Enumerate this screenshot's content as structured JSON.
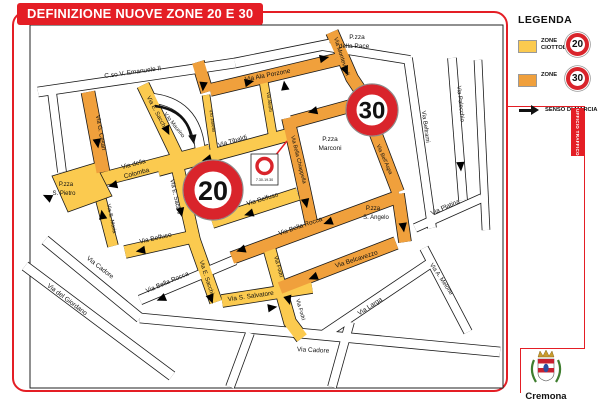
{
  "title": "DEFINIZIONE NUOVE ZONE 20 E 30",
  "colors": {
    "accent_red": "#E41E25",
    "zone20_yellow": "#FBCA4F",
    "zone30_orange": "#F0A03C",
    "sign_ring_red": "#D9242B"
  },
  "legend": {
    "heading": "LEGENDA",
    "zone20_label_line1": "ZONE",
    "zone20_label_line2": "CIOTTOLATE",
    "zone30_label": "ZONE",
    "senso_label": "SENSO DI MARCIA",
    "sign20": "20",
    "sign30": "30"
  },
  "side_tab": "UFFICIO TRAFFICO",
  "logo": {
    "city": "Cremona"
  },
  "map": {
    "sign20": "20",
    "sign30": "30",
    "mini_sign_time": "7.30-19.30",
    "labels": [
      {
        "text": "C.so V. Emanuele II"
      },
      {
        "text": "P.zza"
      },
      {
        "text": "della Pace"
      },
      {
        "text": "Via Ala Porzone"
      },
      {
        "text": "Via Monteverdi"
      },
      {
        "text": "Via G. Cesari"
      },
      {
        "text": "Via E. Sacchi"
      },
      {
        "text": "V.lo Maurino"
      },
      {
        "text": "Via della"
      },
      {
        "text": "Colomba"
      },
      {
        "text": "P.zza"
      },
      {
        "text": "S. Pietro"
      },
      {
        "text": "Via S. Maria"
      },
      {
        "text": "Via Tibaldi"
      },
      {
        "text": "V.lo Janello"
      },
      {
        "text": "Via Aleotti"
      },
      {
        "text": "Via E. Sacchi"
      },
      {
        "text": "Via Belfuso"
      },
      {
        "text": "Via Bella Chiappella"
      },
      {
        "text": "P.zza"
      },
      {
        "text": "Marconi"
      },
      {
        "text": "Via Beltrami"
      },
      {
        "text": "Via Palecchio"
      },
      {
        "text": "Via Bell'Aspa"
      },
      {
        "text": "Via Platina"
      },
      {
        "text": "P.zza"
      },
      {
        "text": "S. Angelo"
      },
      {
        "text": "Via Bella Rocca"
      },
      {
        "text": "Via Belcavezzo"
      },
      {
        "text": "Via A. Melone"
      },
      {
        "text": "Via Larga"
      },
      {
        "text": "Via Fodri"
      },
      {
        "text": "Via Fodri"
      },
      {
        "text": "Via S. Salvatore"
      },
      {
        "text": "Via Belfuso"
      },
      {
        "text": "Via E. Sacchi"
      },
      {
        "text": "Via Bella Rocca"
      },
      {
        "text": "Via Cadore"
      },
      {
        "text": "Via del Giordano"
      },
      {
        "text": "Via Cadore"
      }
    ]
  }
}
